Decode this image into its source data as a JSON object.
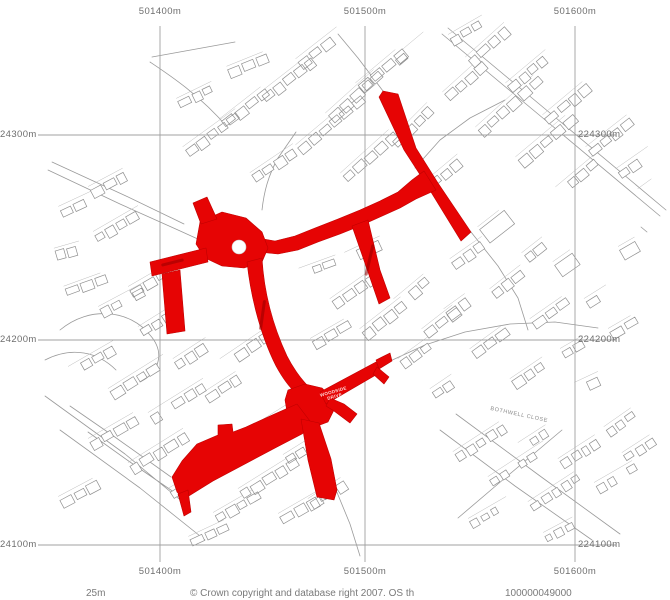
{
  "map": {
    "grid": {
      "top_labels": [
        "501400m",
        "501500m",
        "501600m"
      ],
      "bottom_labels": [
        "501400m",
        "501500m",
        "501600m"
      ],
      "left_labels": [
        "24300m",
        "24200m",
        "24100m"
      ],
      "right_labels": [
        "224300m",
        "224200m",
        "224100m"
      ]
    },
    "street_labels": {
      "woodside_line1": "WOODSIDE",
      "woodside_line2": "DRIVE",
      "bothwell": "BOTHWELL CLOSE"
    },
    "footer": {
      "scale_text": "25m",
      "copyright_text": "© Crown copyright and database right 2007. OS th",
      "licence_number": "100000049000"
    },
    "colors": {
      "highlight_red": "#e60404",
      "linework_gray": "#8f8f8f",
      "grid_gray": "#a0a0a0",
      "label_gray": "#6e6e6e"
    }
  }
}
